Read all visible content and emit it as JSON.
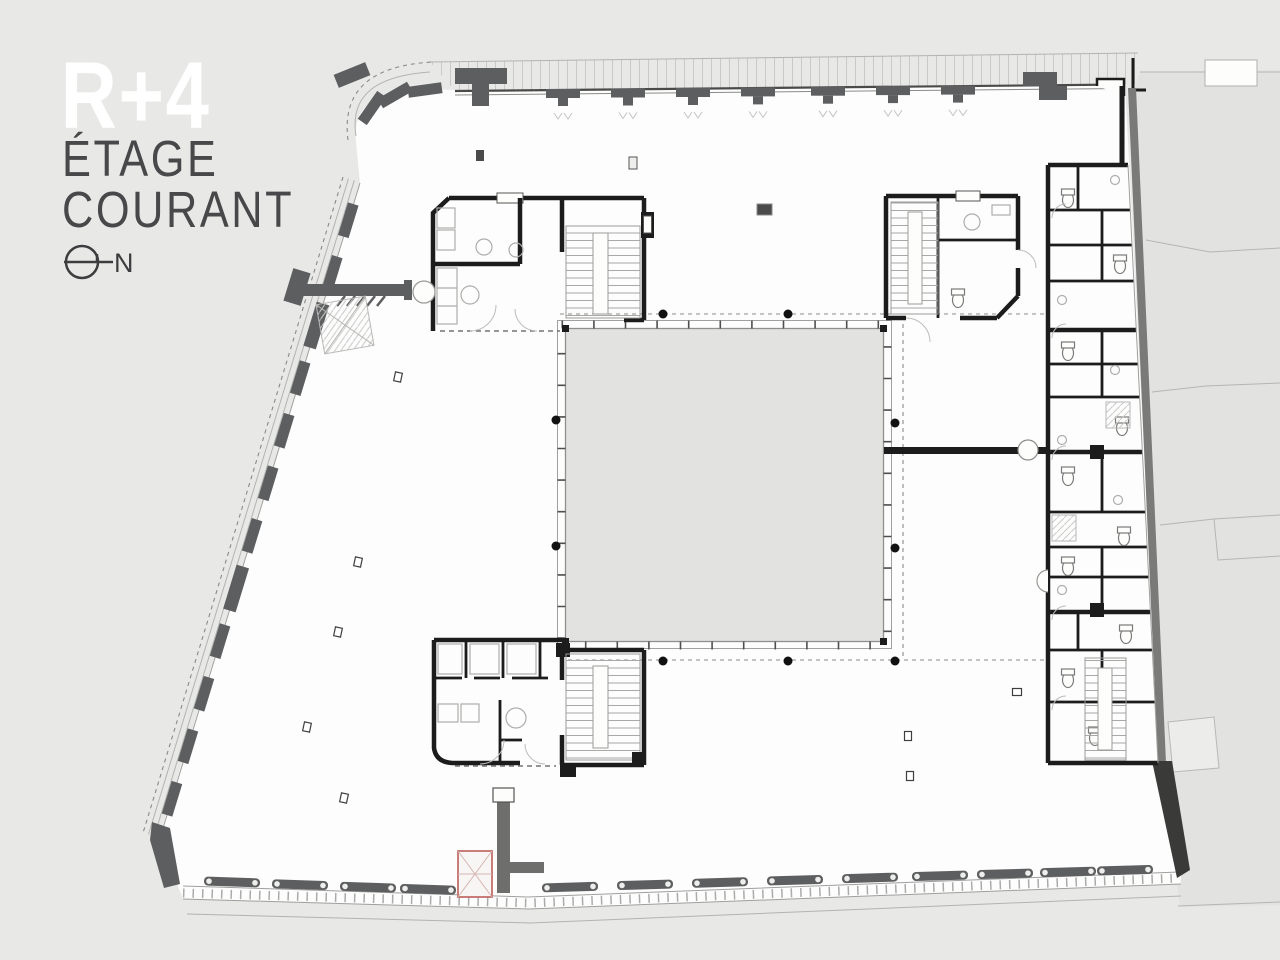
{
  "title_block": {
    "level_label": "R+4",
    "subtitle_line1": "ÉTAGE",
    "subtitle_line2": "COURANT"
  },
  "north_indicator": {
    "label": "N"
  },
  "colors": {
    "background": "#e8e8e7",
    "floor_white": "#fdfdfd",
    "courtyard_fill": "#e2e2e1",
    "wall_black": "#1c1c1c",
    "facade_gray": "#5d5e60",
    "elevator_red_outline": "#c2706a",
    "neighbor_parcel_gray": "#e2e2e0",
    "title_level_color": "#ffffff",
    "subtitle_color": "#48484a"
  }
}
